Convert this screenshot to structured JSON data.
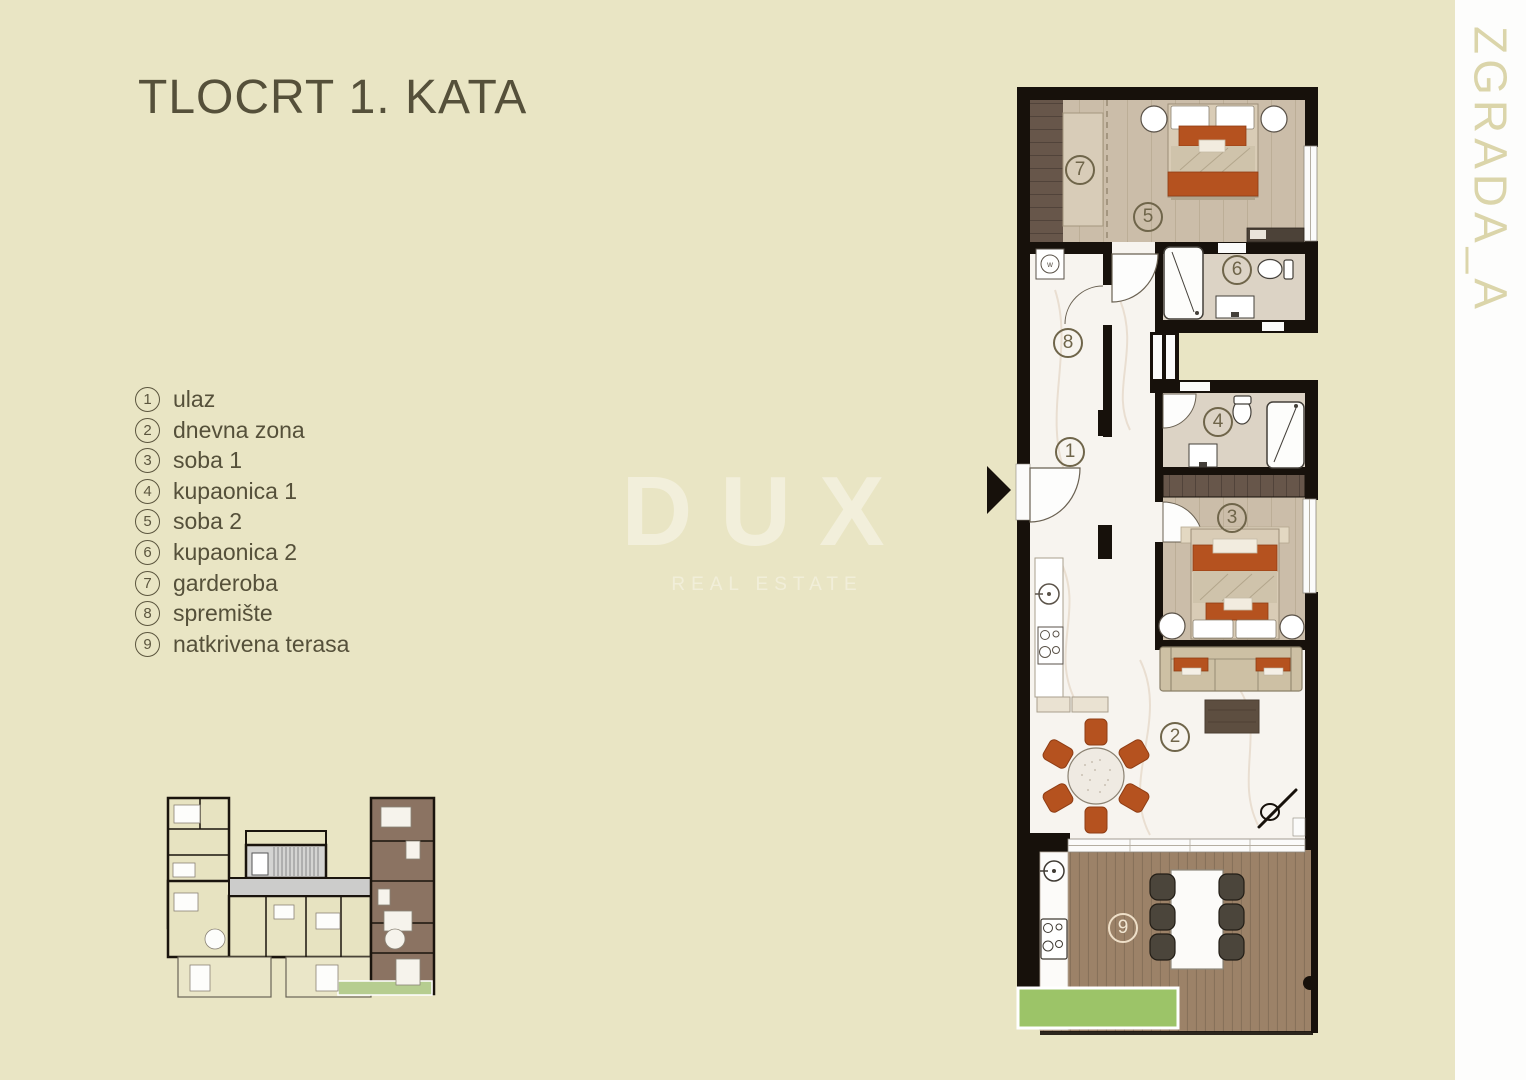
{
  "header": {
    "title": "TLOCRT 1. KATA"
  },
  "building": {
    "label": "ZGRADA_A"
  },
  "watermark": {
    "brand": "DUX",
    "tagline": "REAL ESTATE"
  },
  "rooms": [
    {
      "num": "1",
      "label": "ulaz"
    },
    {
      "num": "2",
      "label": "dnevna zona"
    },
    {
      "num": "3",
      "label": "soba 1"
    },
    {
      "num": "4",
      "label": "kupaonica  1"
    },
    {
      "num": "5",
      "label": "soba 2"
    },
    {
      "num": "6",
      "label": "kupaonica 2"
    },
    {
      "num": "7",
      "label": "garderoba"
    },
    {
      "num": "8",
      "label": "spremište"
    },
    {
      "num": "9",
      "label": "natkrivena terasa"
    }
  ],
  "plan": {
    "washer_label": "w"
  },
  "colors": {
    "background": "#e9e5c4",
    "wall": "#17110b",
    "accent_orange": "#b5521f",
    "wood_floor": "#cbbda9",
    "dark_wood": "#67564a",
    "marble": "#f7f4ef",
    "bath_tile": "#dcd3c5",
    "terrace_deck": "#9c8268",
    "planter_green": "#9cc468",
    "overview_highlight": "#8b7362",
    "label_olive": "#55503a",
    "building_label_color": "#dbd5aa"
  }
}
